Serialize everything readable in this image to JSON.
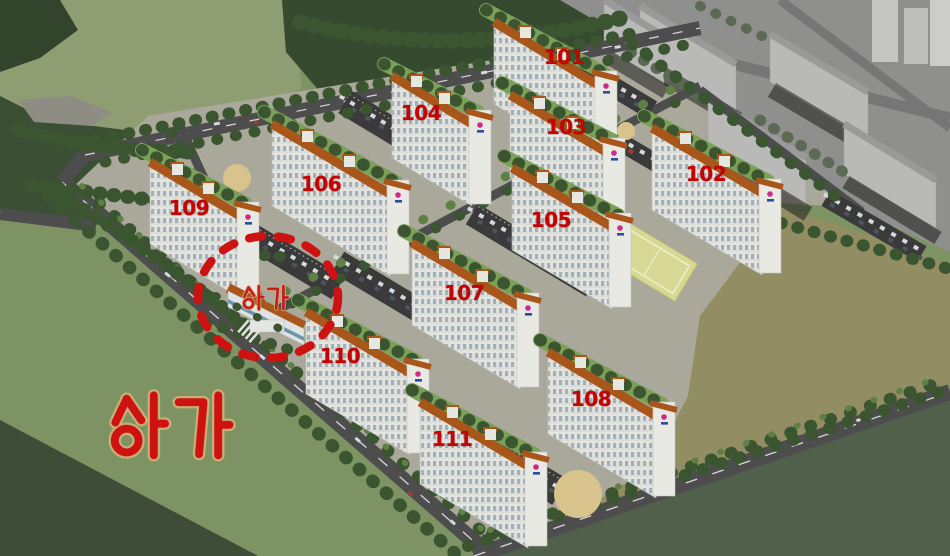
{
  "scene": {
    "description": "Aerial bird's-eye rendering of an apartment complex site plan with numbered buildings, surrounded by a lake, forest, fields and an existing gray city block",
    "language": "ko"
  },
  "buildings": [
    {
      "label": "101"
    },
    {
      "label": "102"
    },
    {
      "label": "103"
    },
    {
      "label": "104"
    },
    {
      "label": "105"
    },
    {
      "label": "106"
    },
    {
      "label": "107"
    },
    {
      "label": "108"
    },
    {
      "label": "109"
    },
    {
      "label": "110"
    },
    {
      "label": "111"
    }
  ],
  "commercial": {
    "small_label": "상가",
    "large_label": "상가",
    "meaning": "commercial building / shops"
  },
  "highlight": {
    "shape": "dashed-circle",
    "color": "#ce1212"
  },
  "colors": {
    "label_red": "#c60404",
    "roof_orange": "#a9561b",
    "water": "#8e9d72",
    "forest": "#36492f",
    "field_green": "#7e9364",
    "field_khaki": "#938d63",
    "road": "#4d4d4d",
    "gray_city": "#8f8f8d"
  }
}
